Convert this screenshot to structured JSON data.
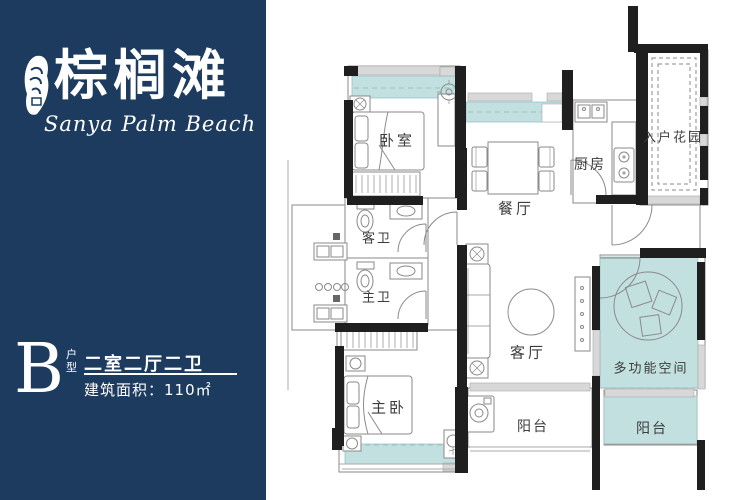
{
  "brand": {
    "logo_cn": "棕榈滩",
    "logo_en": "Sanya Palm Beach"
  },
  "unit_info": {
    "unit_letter": "B",
    "unit_type_label": "户型",
    "layout_desc": "二室二厅二卫",
    "area_desc": "建筑面积：110㎡"
  },
  "floorplan": {
    "rooms": [
      {
        "id": "bedroom",
        "label": "卧室"
      },
      {
        "id": "guest-bathroom",
        "label": "客卫"
      },
      {
        "id": "master-bathroom",
        "label": "主卫"
      },
      {
        "id": "master-bedroom",
        "label": "主卧"
      },
      {
        "id": "dining-room",
        "label": "餐厅"
      },
      {
        "id": "kitchen",
        "label": "厨房"
      },
      {
        "id": "entry-garden",
        "label": "入户花园"
      },
      {
        "id": "living-room",
        "label": "客厅"
      },
      {
        "id": "multi-function-space",
        "label": "多功能空间"
      },
      {
        "id": "balcony-center",
        "label": "阳台"
      },
      {
        "id": "balcony-right",
        "label": "阳台"
      }
    ]
  },
  "colors": {
    "panel_navy": "#1c3b5e",
    "window_teal": "#c2e0e0",
    "wall_black": "#1f1f1f",
    "label_gray": "#3c3c3c"
  }
}
